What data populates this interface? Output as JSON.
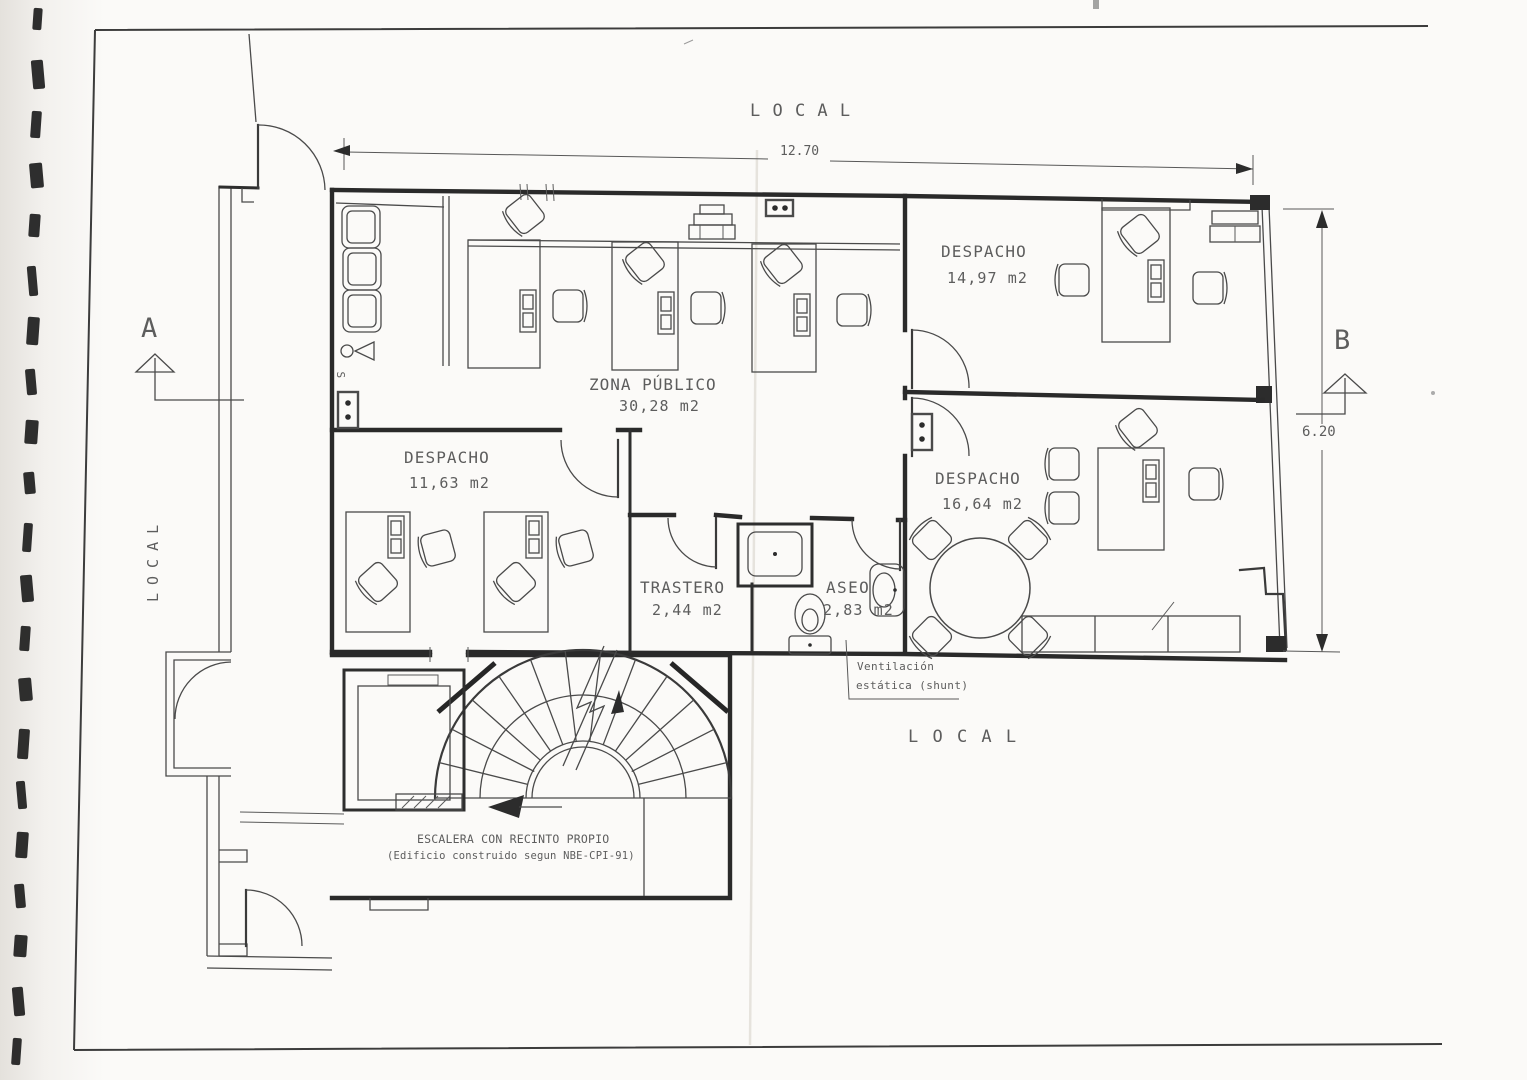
{
  "drawing": {
    "surroundings": {
      "local_top": "L O C A L",
      "local_left": "LOCAL",
      "local_bottom": "L O C A L"
    },
    "dimensions": {
      "overall_width_m": "12.70",
      "overall_depth_m": "6.20"
    },
    "section_markers": {
      "a": "A",
      "b": "B"
    },
    "rooms": {
      "despacho_top": {
        "name": "DESPACHO",
        "area": "14,97 m2"
      },
      "zona_publico": {
        "name": "ZONA PÚBLICO",
        "area": "30,28 m2"
      },
      "despacho_left": {
        "name": "DESPACHO",
        "area": "11,63 m2"
      },
      "despacho_right": {
        "name": "DESPACHO",
        "area": "16,64 m2"
      },
      "trastero": {
        "name": "TRASTERO",
        "area": "2,44 m2"
      },
      "aseo": {
        "name": "ASEO",
        "area": "2,83 m2"
      }
    },
    "annotations": {
      "ventilacion_line1": "Ventilación",
      "ventilacion_line2": "estática (shunt)",
      "escalera_line1": "ESCALERA CON RECINTO PROPIO",
      "escalera_line2": "(Edificio construido segun NBE-CPI-91)",
      "switch": "S"
    }
  }
}
